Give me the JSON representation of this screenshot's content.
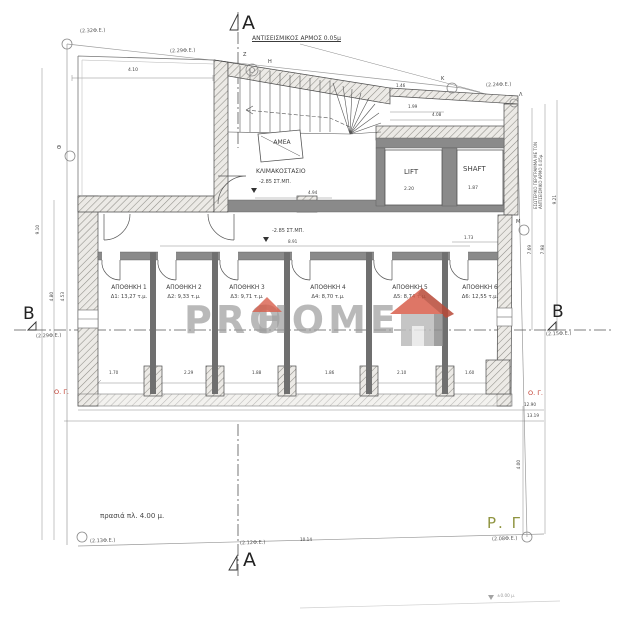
{
  "drawing": {
    "section_a": "A",
    "section_b": "B",
    "seismic_joint": "ΑΝΤΙΣΕΙΣΜΙΚΟΣ ΑΡΜΟΣ 0.05μ",
    "stairwell": "ΚΛΙΜΑΚΟΣΤΑΣΙΟ",
    "amea": "ΑΜΕΑ",
    "lift": "LIFT",
    "shaft": "SHAFT",
    "green_strip": "πρασιά πλ. 4.00 μ.",
    "rg_line": "Ρ. Γ",
    "og_line": "Ο. Γ.",
    "side_note_1": "ΕΣΩΤΕΡΙΚΟ ΠΕΡΙΓΡΑΜΜΑ ΜΕ ΤΟΝ",
    "side_note_2": "ΑΝΤΙΣΕΙΣΜΙΚΟ ΑΡΜΟ 0.05μ",
    "stair_level": "-2.85 ΣΤ.ΜΠ.",
    "corridor_level": "-2.85 ΣΤ.ΜΠ.",
    "street_level": "±0.00 μ."
  },
  "rooms": [
    {
      "label": "ΑΠΟΘΗΚΗ 1",
      "area": "Δ1: 13,27 τ.μ."
    },
    {
      "label": "ΑΠΟΘΗΚΗ 2",
      "area": "Δ2: 9,33 τ.μ."
    },
    {
      "label": "ΑΠΟΘΗΚΗ 3",
      "area": "Δ3: 9,71 τ.μ."
    },
    {
      "label": "ΑΠΟΘΗΚΗ 4",
      "area": "Δ4: 8,70 τ.μ."
    },
    {
      "label": "ΑΠΟΘΗΚΗ 5",
      "area": "Δ5: 8,74 τ.μ."
    },
    {
      "label": "ΑΠΟΘΗΚΗ 6",
      "area": "Δ6: 12,55 τ.μ."
    }
  ],
  "elevations": {
    "top_left": "(2.32Φ.Ε.)",
    "top_mid": "(2.29Φ.Ε.)",
    "top_right": "(2.24Φ.Ε.)",
    "left_b": "(2.29Φ.Ε.)",
    "right_b": "(2.15Φ.Ε.)",
    "bottom_left": "(2.13Φ.Ε.)",
    "bottom_mid": "(2.12Φ.Ε.)",
    "bottom_right": "(2.08Φ.Ε.)"
  },
  "dimensions": {
    "top_block_width": "4.10",
    "lift_block_width": "4.08",
    "lift_inner": "1.99",
    "joint_offset": "1.46",
    "lift_width": "2.20",
    "shaft_width": "1.87",
    "stair_length": "4.94",
    "corridor_length": "8.91",
    "shaft_side": "1.73",
    "room_widths": [
      "1.70",
      "2.29",
      "1.88",
      "1.86",
      "2.10",
      "1.60"
    ],
    "overall_1": "12.90",
    "overall_2": "13.19",
    "street_front": "10.14",
    "left_1": "9.10",
    "left_2": "4.80",
    "left_3": "4.53",
    "right_1": "9.21",
    "right_2": "7.98",
    "right_3": "7.69",
    "garden_depth": "4.00"
  },
  "survey_points": {
    "z": "Z",
    "h": "H",
    "k": "K",
    "l": "Λ",
    "m": "M",
    "th": "Θ"
  },
  "watermark": {
    "pro": "PRO",
    "home": "HOME"
  },
  "colors": {
    "red_label": "#c0392b",
    "olive_label": "#8f9440",
    "watermark_gray": "#9f9f9f",
    "roof_red": "#d95f4c"
  }
}
